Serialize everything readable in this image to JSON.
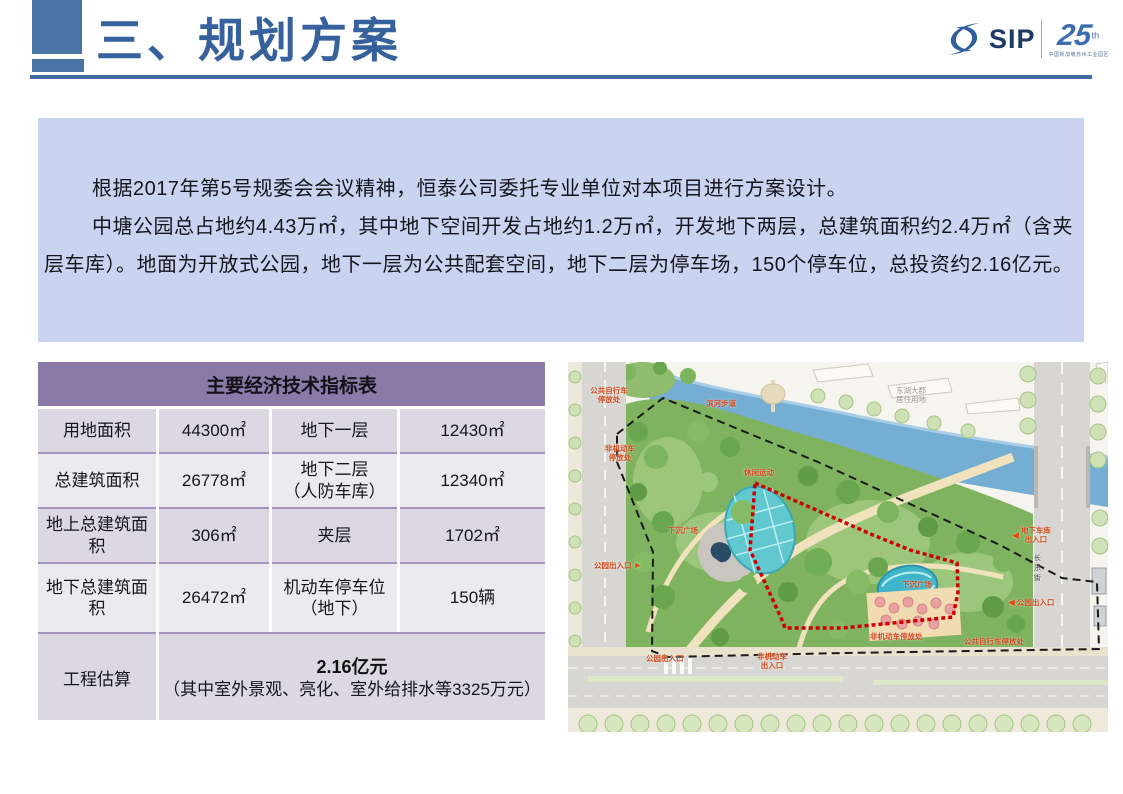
{
  "header": {
    "title": "三、规划方案",
    "logo": {
      "sip": "SIP",
      "anniversary_number": "25",
      "anniversary_suffix": "th",
      "anniversary_subtext": "中国新加坡苏州工业园区"
    }
  },
  "intro": {
    "paragraph_1": "根据2017年第5号规委会会议精神，恒泰公司委托专业单位对本项目进行方案设计。",
    "paragraph_2": "中塘公园总占地约4.43万㎡，其中地下空间开发占地约1.2万㎡，开发地下两层，总建筑面积约2.4万㎡（含夹层车库）。地面为开放式公园，地下一层为公共配套空间，地下二层为停车场，150个停车位，总投资约2.16亿元。"
  },
  "table": {
    "title": "主要经济技术指标表",
    "rows": [
      {
        "label": "用地面积",
        "value": "44300㎡",
        "label2": "地下一层",
        "value2": "12430㎡"
      },
      {
        "label": "总建筑面积",
        "value": "26778㎡",
        "label2": "地下二层\n（人防车库）",
        "value2": "12340㎡"
      },
      {
        "label": "地上总建筑面积",
        "value": "306㎡",
        "label2": "夹层",
        "value2": "1702㎡"
      },
      {
        "label": "地下总建筑面积",
        "value": "26472㎡",
        "label2": "机动车停车位\n（地下）",
        "value2": "150辆"
      }
    ],
    "estimate": {
      "label": "工程估算",
      "amount": "2.16亿元",
      "note": "（其中室外景观、亮化、室外给排水等3325万元）"
    }
  },
  "site_plan": {
    "labels": {
      "bike_parking_top": "公共自行车\n停放处",
      "riverside_walk": "滨河步道",
      "non_motor_parking_left": "非机动车\n停放处",
      "sunken_plaza": "下沉广场",
      "leisure_sports": "休闲运动",
      "underground_garage_entrance": "地下车库\n出入口",
      "park_entrance_right": "公园出入口",
      "changle_street": "长乐街",
      "sunken_plaza_right": "下沉广场",
      "non_motor_parking_bottom": "非机动车停放处",
      "bike_parking_bottom": "公共自行车停放处",
      "park_entrance_left": "公园出入口",
      "park_entrance_bottom": "公园出入口",
      "non_motor_entrance_bottom": "非机动车\n出入口",
      "residential_area_note": "东湖大郡\n居住用地"
    },
    "arrows": {
      "left": "◀",
      "right": "►",
      "up": "▲"
    }
  },
  "colors": {
    "accent_blue": "#35619c",
    "box_blue": "#cad3f0",
    "table_header_purple": "#8b79a8",
    "row_dark": "#dbd7e3",
    "row_light": "#eceaf1",
    "label_red": "#d14a1e"
  }
}
